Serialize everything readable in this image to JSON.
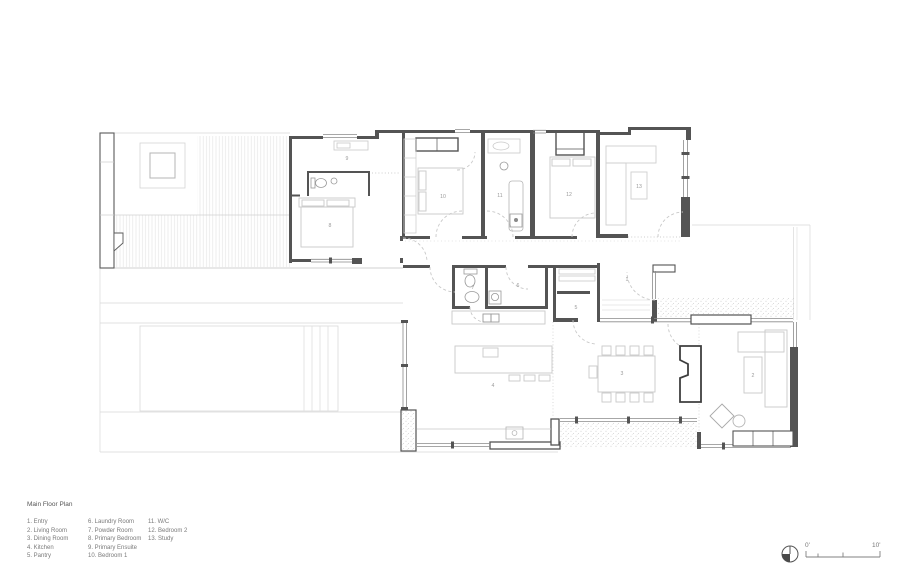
{
  "title": "Main Floor Plan",
  "legend": {
    "columns": [
      {
        "items": [
          "1. Entry",
          "2. Living Room",
          "3. Dining Room",
          "4. Kitchen",
          "5. Pantry"
        ]
      },
      {
        "items": [
          "6. Laundry Room",
          "7. Powder Room",
          "8. Primary Bedroom",
          "9. Primary Ensuite",
          "10. Bedroom 1"
        ]
      },
      {
        "items": [
          "11. W/C",
          "12. Bedroom 2",
          "13. Study"
        ]
      }
    ]
  },
  "plan": {
    "room_numbers": [
      "1",
      "2",
      "3",
      "4",
      "5",
      "6",
      "7",
      "8",
      "9",
      "10",
      "11",
      "12",
      "13"
    ]
  },
  "scale_bar": {
    "zero_label": "0'",
    "ten_label": "10'"
  },
  "colors": {
    "wall": "#4d4d4d",
    "furniture": "#c9c9c9",
    "hatch": "#e6e6e6",
    "text": "#7a7a7a"
  }
}
